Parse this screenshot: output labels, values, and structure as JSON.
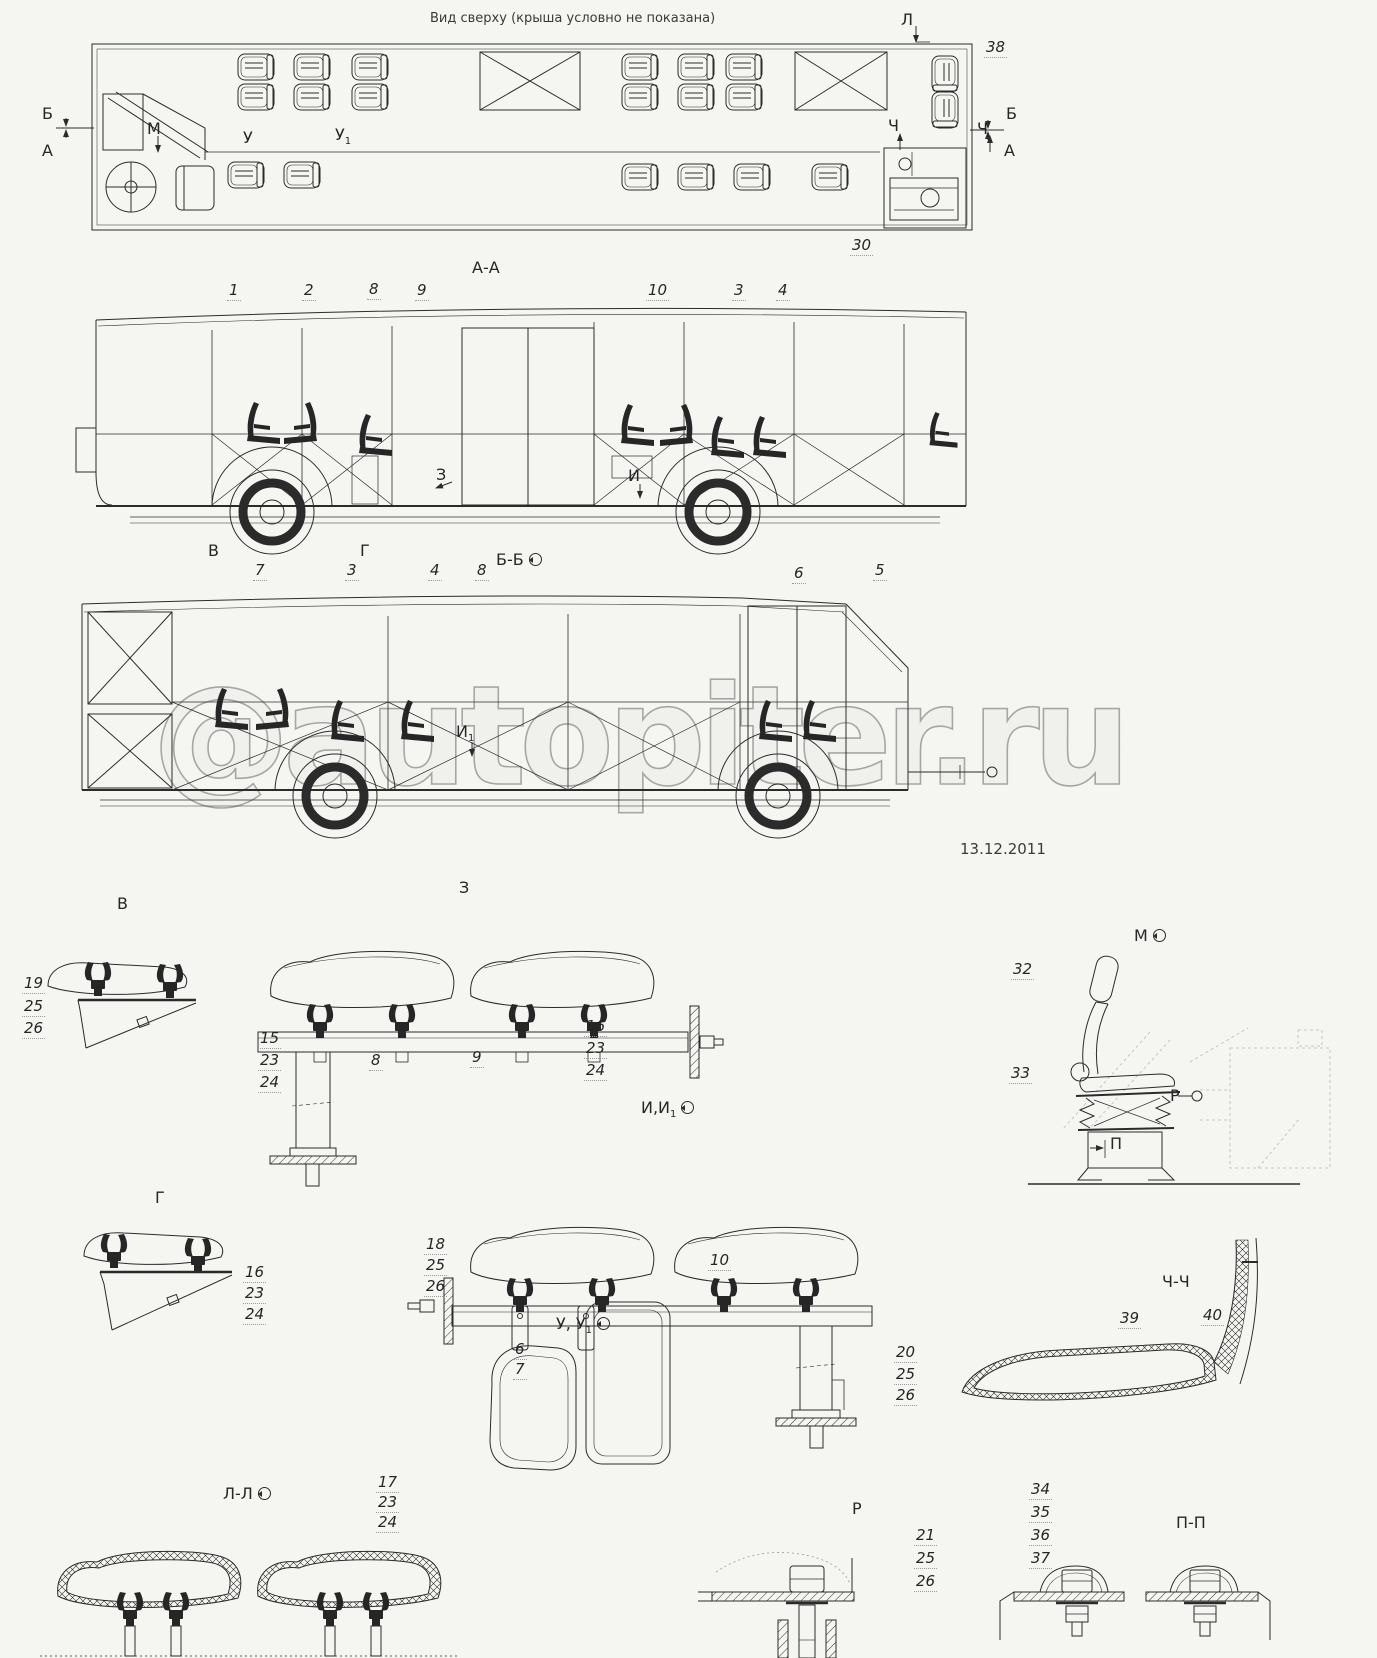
{
  "meta": {
    "ink": "#2b2b2b",
    "background": "#f5f5f2",
    "watermark_color": "#a6a6a6"
  },
  "watermark": {
    "at": "@",
    "site": "autopiter.ru",
    "date": "13.12.2011"
  },
  "titles": {
    "top_view": "Вид сверху (крыша условно не показана)",
    "section_aa": "А-А",
    "section_bb": "Б-Б",
    "detail_v": "В",
    "detail_z": "З",
    "detail_g": "Г",
    "detail_ii1_base": "И,И",
    "detail_ii1_sub": "1",
    "detail_m": "М",
    "detail_uu1_base": "У, У",
    "detail_uu1_sub": "1",
    "section_chch": "Ч-Ч",
    "section_ll": "Л-Л",
    "detail_r": "Р",
    "section_pp": "П-П"
  },
  "markers": {
    "l": "Л",
    "b_left": "Б",
    "a_left": "А",
    "b_right": "Б",
    "a_right": "А",
    "ch_left": "Ч",
    "ch_right": "Ч",
    "m": "М",
    "u": "У",
    "u1_base": "У",
    "u1_sub": "1",
    "z": "З",
    "i": "И",
    "i1_base": "И",
    "i1_sub": "1",
    "v": "В",
    "g": "Г",
    "r": "Р",
    "p": "П"
  },
  "part_numbers": {
    "top_38": "38",
    "top_30": "30",
    "aa_row": [
      "1",
      "2",
      "8",
      "9",
      "10",
      "3",
      "4"
    ],
    "bb_row": [
      "7",
      "3",
      "4",
      "8",
      "6",
      "5"
    ],
    "detail_v": [
      "19",
      "25",
      "26"
    ],
    "detail_z_left": [
      "15",
      "23",
      "24"
    ],
    "detail_z_mid": [
      "8",
      "9"
    ],
    "detail_z_right": [
      "16",
      "23",
      "24"
    ],
    "detail_m": [
      "32",
      "33"
    ],
    "detail_g": [
      "16",
      "23",
      "24"
    ],
    "detail_i_left": [
      "18",
      "25",
      "26"
    ],
    "detail_i_rail": "10",
    "detail_i_leg": [
      "20",
      "25",
      "26"
    ],
    "detail_u": [
      "6",
      "7"
    ],
    "chch": [
      "39",
      "40"
    ],
    "ll": [
      "17",
      "23",
      "24"
    ],
    "r": [
      "21",
      "25",
      "26"
    ],
    "pp": [
      "34",
      "35",
      "36",
      "37"
    ]
  }
}
